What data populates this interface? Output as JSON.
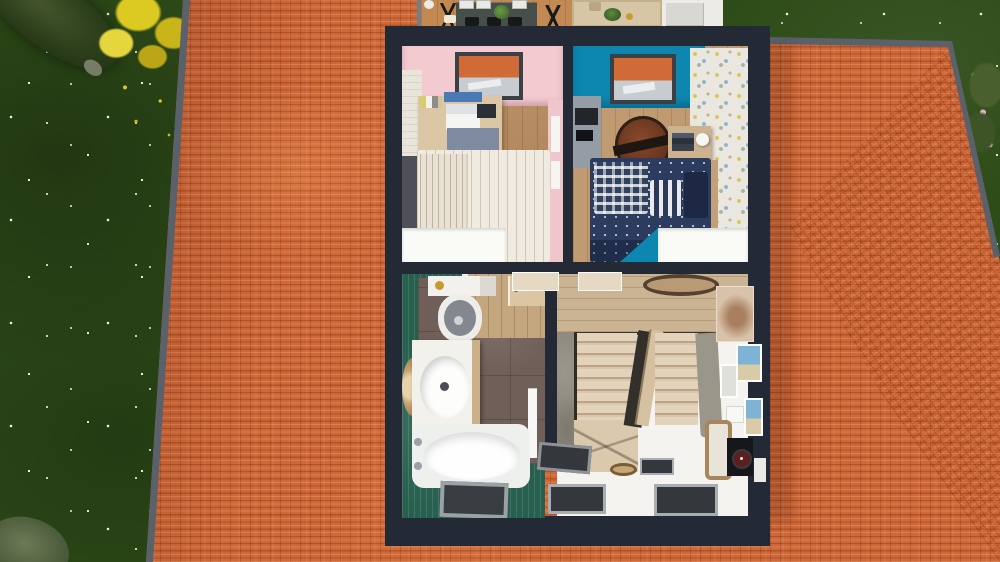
{
  "scene": {
    "description": "Aerial 3D dollhouse view of a house upper floor cutaway, surrounded by a terracotta tiled hip roof and a garden lawn",
    "view": "top-down 3D render",
    "exterior": {
      "lawn": "dark green grass scattered with small white flowers",
      "trees": [
        "dark conifer",
        "yellow-foliage tree",
        "gray-green shrub",
        "pink flowering bush"
      ],
      "roof": "terracotta tile hip roof with gray gutters"
    },
    "ground_floor_glimpse": {
      "items": [
        "dining table",
        "white chairs",
        "black chairs",
        "black easel chair",
        "potted plant",
        "beige area rug",
        "round planter",
        "white sofa",
        "white mug"
      ]
    },
    "rooms": [
      {
        "name": "bedroom-pink",
        "wall_finish": "pink paint with white brick accent wall",
        "floor": "wood planks",
        "contents": [
          "skylight roof window",
          "wood desk",
          "white laptop",
          "blue poster",
          "dark tablet",
          "books",
          "gray-blue bench",
          "single bed with striped white duvet",
          "dark headboard",
          "white sloped-ceiling cut"
        ]
      },
      {
        "name": "bedroom-blue",
        "wall_finish": "cyan paint with multicolor mosaic wallpaper",
        "floor": "wood planks",
        "contents": [
          "skylight roof window",
          "gray desk with monitor",
          "round basketball rug",
          "nightstand with books and lamp",
          "bed with navy patterned duvet",
          "checkered pillow",
          "striped pillow",
          "cyan sloped-wall wedge",
          "white sloped-ceiling cut"
        ]
      },
      {
        "name": "bathroom",
        "wall_finish": "green zellige tile",
        "floor": "dark brown tile",
        "contents": [
          "toilet with gold flush",
          "white vanity with round basin",
          "round rattan mirror",
          "bathtub with faucet",
          "white towel ladder",
          "recessed roof window",
          "wood doorway with open door"
        ]
      },
      {
        "name": "hallway-landing",
        "wall_finish": "white walls with gallery pictures",
        "floor": "wood planks and white sloped ceiling",
        "contents": [
          "U-shaped staircase",
          "concrete stair wall",
          "oval rug",
          "two open doors",
          "large beige photo",
          "blue seaside cards",
          "small gray photos",
          "wood-framed mirror",
          "black frame with dark red clock",
          "small round rug",
          "three recessed roof windows"
        ]
      }
    ]
  },
  "palette": {
    "grass": "#2e4c18",
    "flower": "#f1efd2",
    "roof-tile": "#cf6838",
    "gutter": "#5a616b",
    "wall-dark": "#242936",
    "wood-bed": "#b78c60",
    "wood-hall": "#cbb493",
    "wood-gf": "#c28a52",
    "pink": "#f2cad0",
    "cyan": "#0d86b0",
    "mosaic": "#e9e7df",
    "white-cut": "#fafaf7",
    "teal-tile": "#27604f",
    "bath-floor": "#6f5f58",
    "navy": "#2c3c5e",
    "tread": "#ddcbb1",
    "concrete": "#8e897c",
    "fixture": "#f2f1ec"
  }
}
